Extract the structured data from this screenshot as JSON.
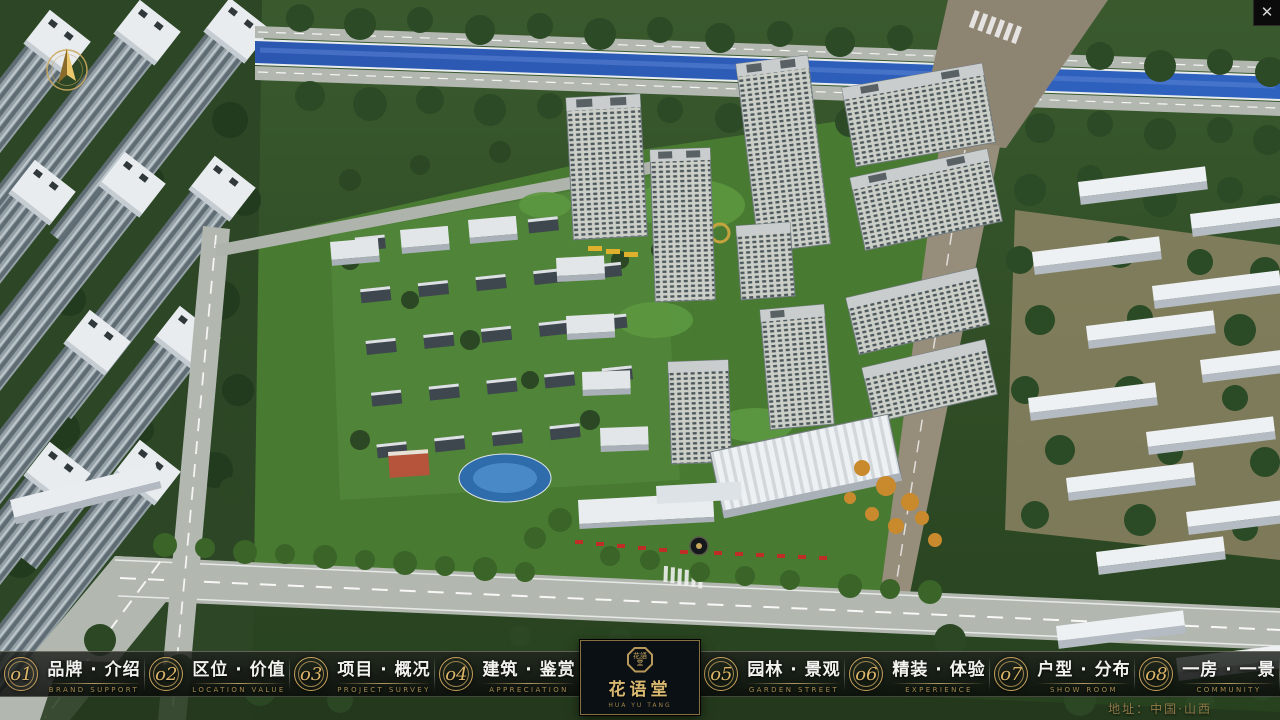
{
  "window": {
    "close_glyph": "✕"
  },
  "nav": {
    "items": [
      {
        "number": "o1",
        "zh": "品牌 · 介绍",
        "en": "BRAND SUPPORT"
      },
      {
        "number": "o2",
        "zh": "区位 · 价值",
        "en": "LOCATION VALUE"
      },
      {
        "number": "o3",
        "zh": "项目 · 概况",
        "en": "PROJECT SURVEY"
      },
      {
        "number": "o4",
        "zh": "建筑 · 鉴赏",
        "en": "APPRECIATION"
      },
      {
        "number": "o5",
        "zh": "园林 · 景观",
        "en": "GARDEN STREET"
      },
      {
        "number": "o6",
        "zh": "精装 · 体验",
        "en": "EXPERIENCE"
      },
      {
        "number": "o7",
        "zh": "户型 · 分布",
        "en": "SHOW ROOM"
      },
      {
        "number": "o8",
        "zh": "一房 · 一景",
        "en": "COMMUNITY"
      }
    ]
  },
  "logo": {
    "seal_text": "花語堂",
    "title": "花语堂",
    "subtitle": "HUA YU TANG"
  },
  "footer": {
    "address": "地址：中国·山西"
  },
  "colors": {
    "gold": "#cda85e",
    "nav_text": "#f2f2ee",
    "nav_en": "#a58c51",
    "river": "#2f63c0",
    "bar_bg": "rgba(9,11,9,0.84)"
  }
}
